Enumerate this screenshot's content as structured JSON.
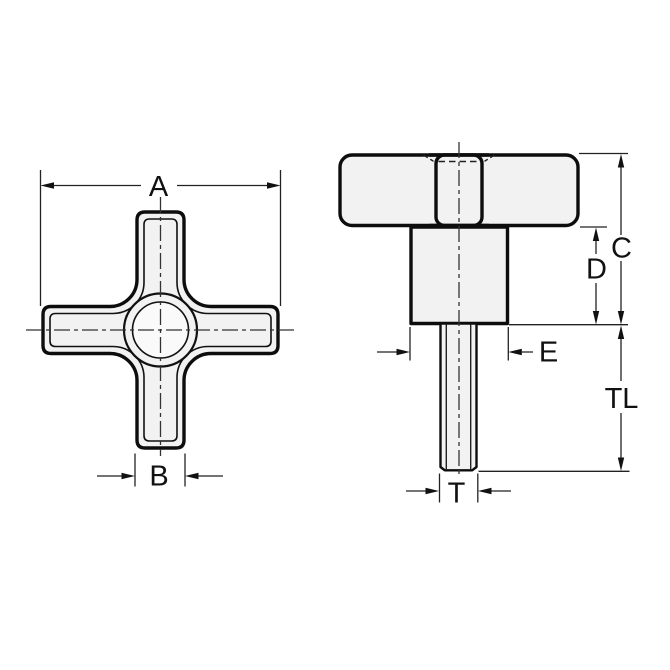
{
  "drawing": {
    "type": "technical-dimension-drawing",
    "subject": "four-arm cross knob with threaded stud",
    "views": {
      "front": "front view (cross profile)",
      "side": "side view (head, hub, threaded stem)"
    },
    "labels": {
      "a": "A",
      "b": "B",
      "c": "C",
      "d": "D",
      "e": "E",
      "tl": "TL",
      "t": "T"
    }
  },
  "colors": {
    "background": "#ffffff",
    "outline": "#0d0d0d",
    "part_fill": "#f2f2f2",
    "hole_fill": "#fafafa",
    "dimension_line": "#222222",
    "centerline": "#333333",
    "label_text": "#111111"
  }
}
